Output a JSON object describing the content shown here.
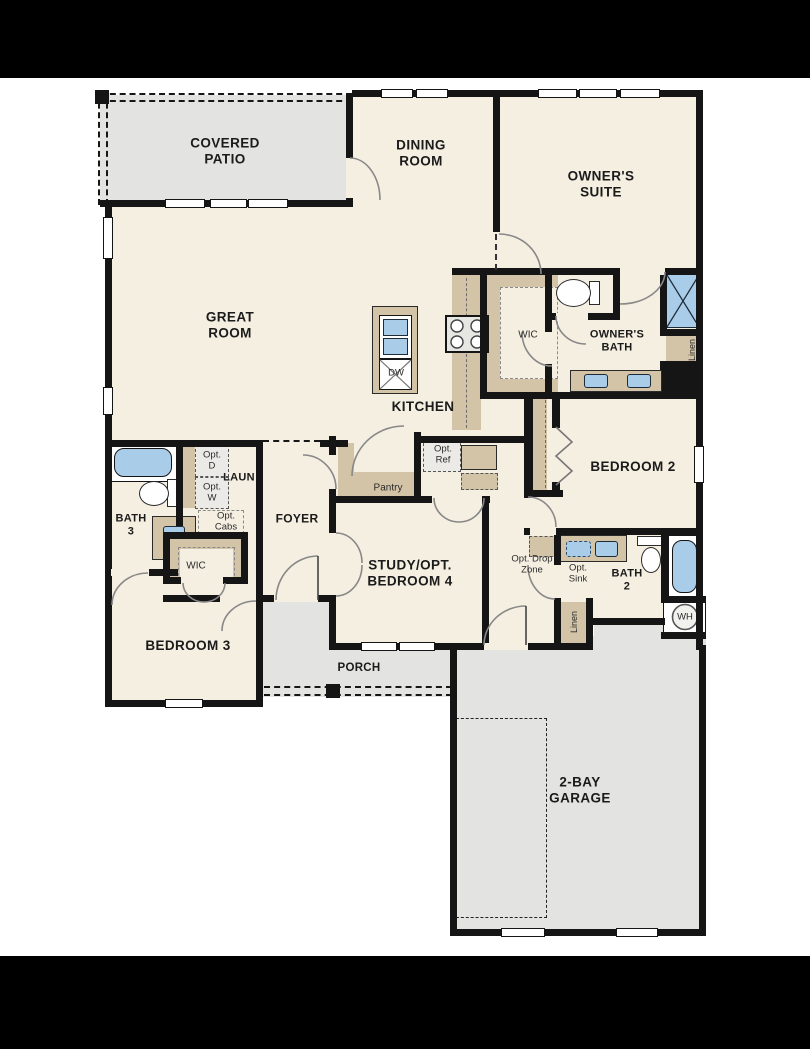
{
  "title": "Single-story home floor plan",
  "colors": {
    "cream": "#f5efe2",
    "gray": "#e3e3e1",
    "tan": "#d3c4a7",
    "blue": "#a9cce9",
    "optbox": "#eceae6",
    "wall": "#151515"
  },
  "labels": {
    "covered_patio": "COVERED\nPATIO",
    "dining_room": "DINING\nROOM",
    "owners_suite": "OWNER'S\nSUITE",
    "great_room": "GREAT\nROOM",
    "kitchen": "KITCHEN",
    "dw": "DW",
    "wic_owner": "WIC",
    "owners_bath": "OWNER'S\nBATH",
    "linen_owner": "Linen",
    "bedroom2": "BEDROOM 2",
    "bath3": "BATH\n3",
    "laun": "LAUN",
    "opt_d": "Opt.\nD",
    "opt_w": "Opt.\nW",
    "opt_cabs": "Opt.\nCabs",
    "wic_bed3": "WIC",
    "foyer": "FOYER",
    "pantry": "Pantry",
    "opt_ref": "Opt.\nRef",
    "study": "STUDY/OPT.\nBEDROOM 4",
    "opt_drop_zone": "Opt. Drop\nZone",
    "opt_sink": "Opt.\nSink",
    "bath2": "BATH\n2",
    "linen_hall": "Linen",
    "wh": "WH",
    "bedroom3": "BEDROOM 3",
    "porch": "PORCH",
    "garage": "2-BAY\nGARAGE"
  }
}
